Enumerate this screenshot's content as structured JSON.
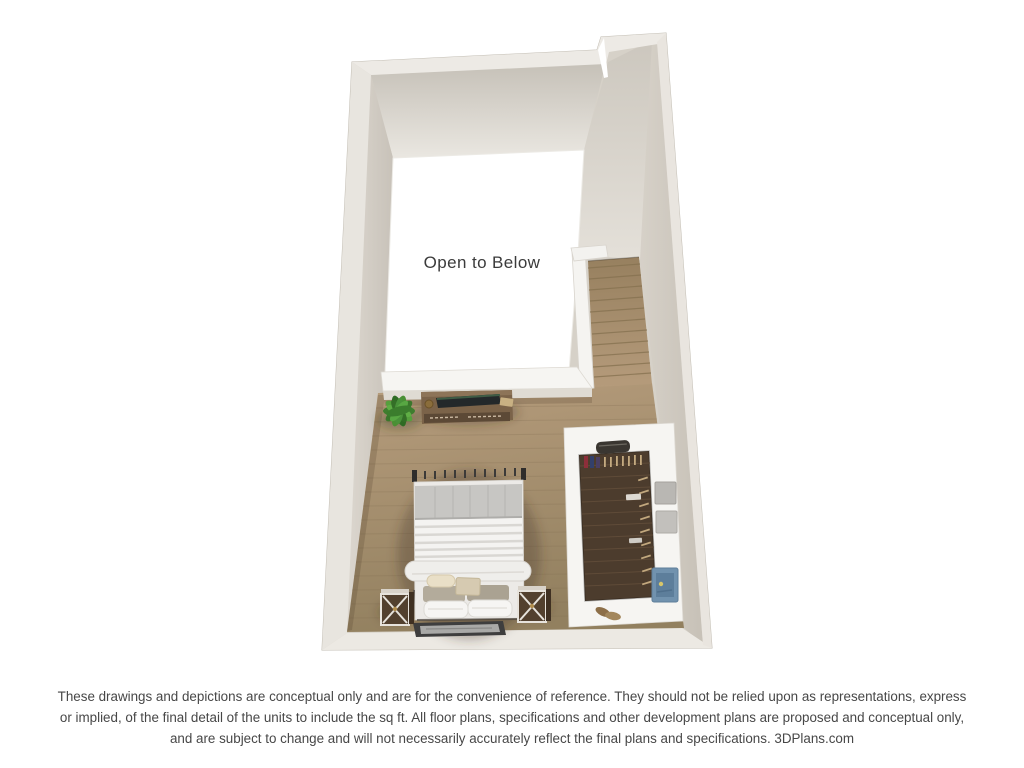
{
  "figure": {
    "room_label": "Open to Below",
    "scene_items": [
      "open-to-below-void",
      "staircase",
      "stair-railing",
      "half-wall-ledge",
      "bedroom-wood-floor",
      "bed",
      "headboard",
      "pillows",
      "area-rug",
      "nightstand-left",
      "nightstand-right",
      "dresser",
      "flat-screen-tv",
      "potted-plant",
      "walk-in-closet",
      "clothes-hangers",
      "storage-boxes",
      "wall-art",
      "shoes",
      "duffel-bag"
    ],
    "colors": {
      "wall": "#d6d1c8",
      "wall_top": "#edeae5",
      "bedroom_floor": "#a68c6c",
      "stair_wood": "#a48a6a",
      "closet_floor": "#4c3c2d",
      "void_floor": "#ffffff",
      "plant_green": "#4f8f38",
      "art_blue": "#7192ae",
      "label_text": "#3b3b3b",
      "disclaimer_text": "#474747"
    }
  },
  "disclaimer": {
    "lines": [
      "These drawings and depictions are conceptual only and are for the convenience of reference. They should not be relied upon as representations, express",
      "or implied, of the final detail of the units to include the sq ft. All floor plans, specifications and other development plans are proposed and conceptual only,",
      "and are subject to change and will not necessarily accurately reflect the final plans and specifications. 3DPlans.com"
    ]
  }
}
